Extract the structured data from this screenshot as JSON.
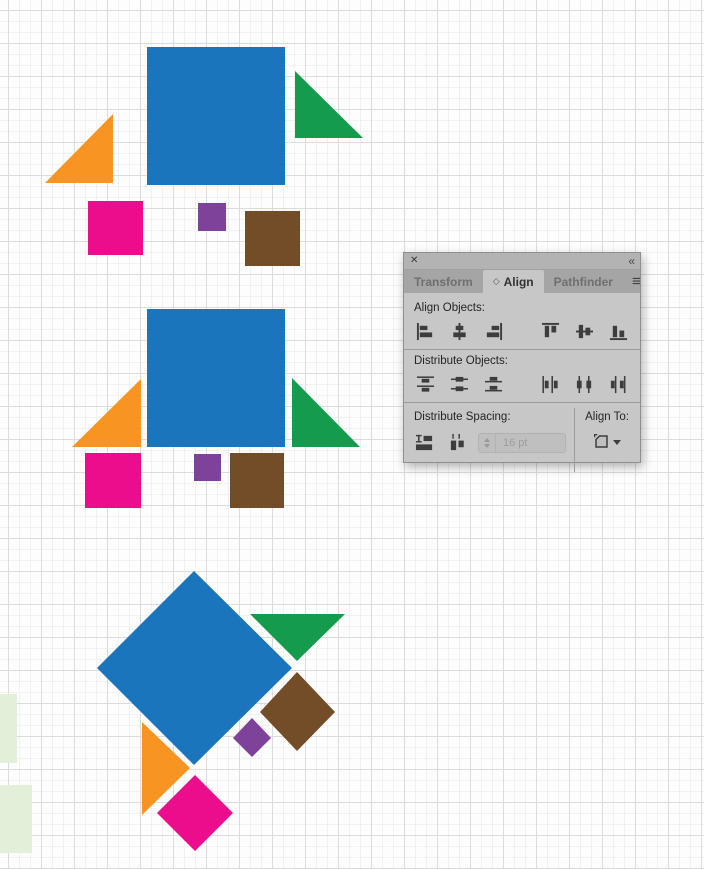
{
  "panel": {
    "window": {
      "close_icon": "✕",
      "collapse_icon": "«",
      "menu_icon": "≡",
      "tab_cycle_icon": "◇"
    },
    "tabs": [
      {
        "label": "Transform",
        "active": false
      },
      {
        "label": "Align",
        "active": true
      },
      {
        "label": "Pathfinder",
        "active": false
      }
    ],
    "align_objects": {
      "label": "Align Objects:",
      "buttons": [
        {
          "name": "horizontal-align-left",
          "icon": "align-left",
          "label": "Horizontal Align Left"
        },
        {
          "name": "horizontal-align-center",
          "icon": "align-hcenter",
          "label": "Horizontal Align Center"
        },
        {
          "name": "horizontal-align-right",
          "icon": "align-right",
          "label": "Horizontal Align Right"
        },
        {
          "name": "vertical-align-top",
          "icon": "align-top",
          "label": "Vertical Align Top"
        },
        {
          "name": "vertical-align-center",
          "icon": "align-vcenter",
          "label": "Vertical Align Center"
        },
        {
          "name": "vertical-align-bottom",
          "icon": "align-bottom",
          "label": "Vertical Align Bottom"
        }
      ]
    },
    "distribute_objects": {
      "label": "Distribute Objects:",
      "buttons": [
        {
          "name": "vertical-distribute-top",
          "icon": "dist-vtop",
          "label": "Vertical Distribute Top"
        },
        {
          "name": "vertical-distribute-center",
          "icon": "dist-vcenter",
          "label": "Vertical Distribute Center"
        },
        {
          "name": "vertical-distribute-bottom",
          "icon": "dist-vbottom",
          "label": "Vertical Distribute Bottom"
        },
        {
          "name": "horizontal-distribute-left",
          "icon": "dist-hleft",
          "label": "Horizontal Distribute Left"
        },
        {
          "name": "horizontal-distribute-center",
          "icon": "dist-hcenter",
          "label": "Horizontal Distribute Center"
        },
        {
          "name": "horizontal-distribute-right",
          "icon": "dist-hright",
          "label": "Horizontal Distribute Right"
        }
      ]
    },
    "distribute_spacing": {
      "label": "Distribute Spacing:",
      "value": "16 pt",
      "buttons": [
        {
          "name": "vertical-distribute-space",
          "icon": "spacing-v",
          "label": "Vertical Distribute Space"
        },
        {
          "name": "horizontal-distribute-space",
          "icon": "spacing-h",
          "label": "Horizontal Distribute Space"
        }
      ]
    },
    "align_to": {
      "label": "Align To:",
      "button_label": "Align To Artboard"
    }
  },
  "canvas": {
    "palette": {
      "blue": "#1B75BC",
      "orange": "#F79422",
      "green": "#149B4D",
      "magenta": "#EC0D8C",
      "purple": "#7E429B",
      "brown": "#734C28",
      "pale_green": "#E4EFD9"
    },
    "background_objects": [
      {
        "name": "pasteboard-object-small",
        "kind": "rect",
        "x": 0,
        "y": 694,
        "w": 17,
        "h": 69,
        "color": "pale_green"
      },
      {
        "name": "pasteboard-object-large",
        "kind": "rect",
        "x": 0,
        "y": 785,
        "w": 32,
        "h": 68,
        "color": "pale_green"
      }
    ],
    "groups": [
      {
        "name": "group-top-scattered",
        "shapes": [
          {
            "name": "blue-square",
            "kind": "rect",
            "x": 147,
            "y": 47,
            "w": 138,
            "h": 138,
            "color": "blue"
          },
          {
            "name": "orange-triangle",
            "kind": "polygon",
            "points": "113,114 113,183 45,183",
            "color": "orange"
          },
          {
            "name": "green-triangle",
            "kind": "polygon",
            "points": "295,71 295,138 363,138",
            "color": "green"
          },
          {
            "name": "magenta-square",
            "kind": "rect",
            "x": 88,
            "y": 201,
            "w": 55,
            "h": 54,
            "color": "magenta"
          },
          {
            "name": "purple-square",
            "kind": "rect",
            "x": 198,
            "y": 203,
            "w": 28,
            "h": 28,
            "color": "purple"
          },
          {
            "name": "brown-square",
            "kind": "rect",
            "x": 245,
            "y": 211,
            "w": 55,
            "h": 55,
            "color": "brown"
          }
        ]
      },
      {
        "name": "group-middle-aligned",
        "shapes": [
          {
            "name": "blue-square",
            "kind": "rect",
            "x": 147,
            "y": 309,
            "w": 138,
            "h": 138,
            "color": "blue"
          },
          {
            "name": "orange-triangle",
            "kind": "polygon",
            "points": "141,379 141,447 72,447",
            "color": "orange"
          },
          {
            "name": "green-triangle",
            "kind": "polygon",
            "points": "292,378 292,447 360,447",
            "color": "green"
          },
          {
            "name": "magenta-square",
            "kind": "rect",
            "x": 85,
            "y": 453,
            "w": 56,
            "h": 55,
            "color": "magenta"
          },
          {
            "name": "purple-square",
            "kind": "rect",
            "x": 194,
            "y": 454,
            "w": 27,
            "h": 27,
            "color": "purple"
          },
          {
            "name": "brown-square",
            "kind": "rect",
            "x": 230,
            "y": 453,
            "w": 54,
            "h": 55,
            "color": "brown"
          }
        ]
      },
      {
        "name": "group-bottom-rotated",
        "shapes": [
          {
            "name": "blue-diamond",
            "kind": "polygon",
            "points": "194,571 292,668 194,765 97,668",
            "color": "blue"
          },
          {
            "name": "green-triangle",
            "kind": "polygon",
            "points": "250,614 345,614 297,661",
            "color": "green"
          },
          {
            "name": "brown-diamond",
            "kind": "polygon",
            "points": "297,672 335,712 297,751 260,712",
            "color": "brown"
          },
          {
            "name": "purple-diamond",
            "kind": "polygon",
            "points": "252,718 271,738 252,757 233,738",
            "color": "purple"
          },
          {
            "name": "orange-triangle",
            "kind": "polygon",
            "points": "142,722 190,768 142,815",
            "color": "orange"
          },
          {
            "name": "magenta-diamond",
            "kind": "polygon",
            "points": "195,775 233,813 195,851 157,813",
            "color": "magenta"
          }
        ]
      }
    ]
  }
}
